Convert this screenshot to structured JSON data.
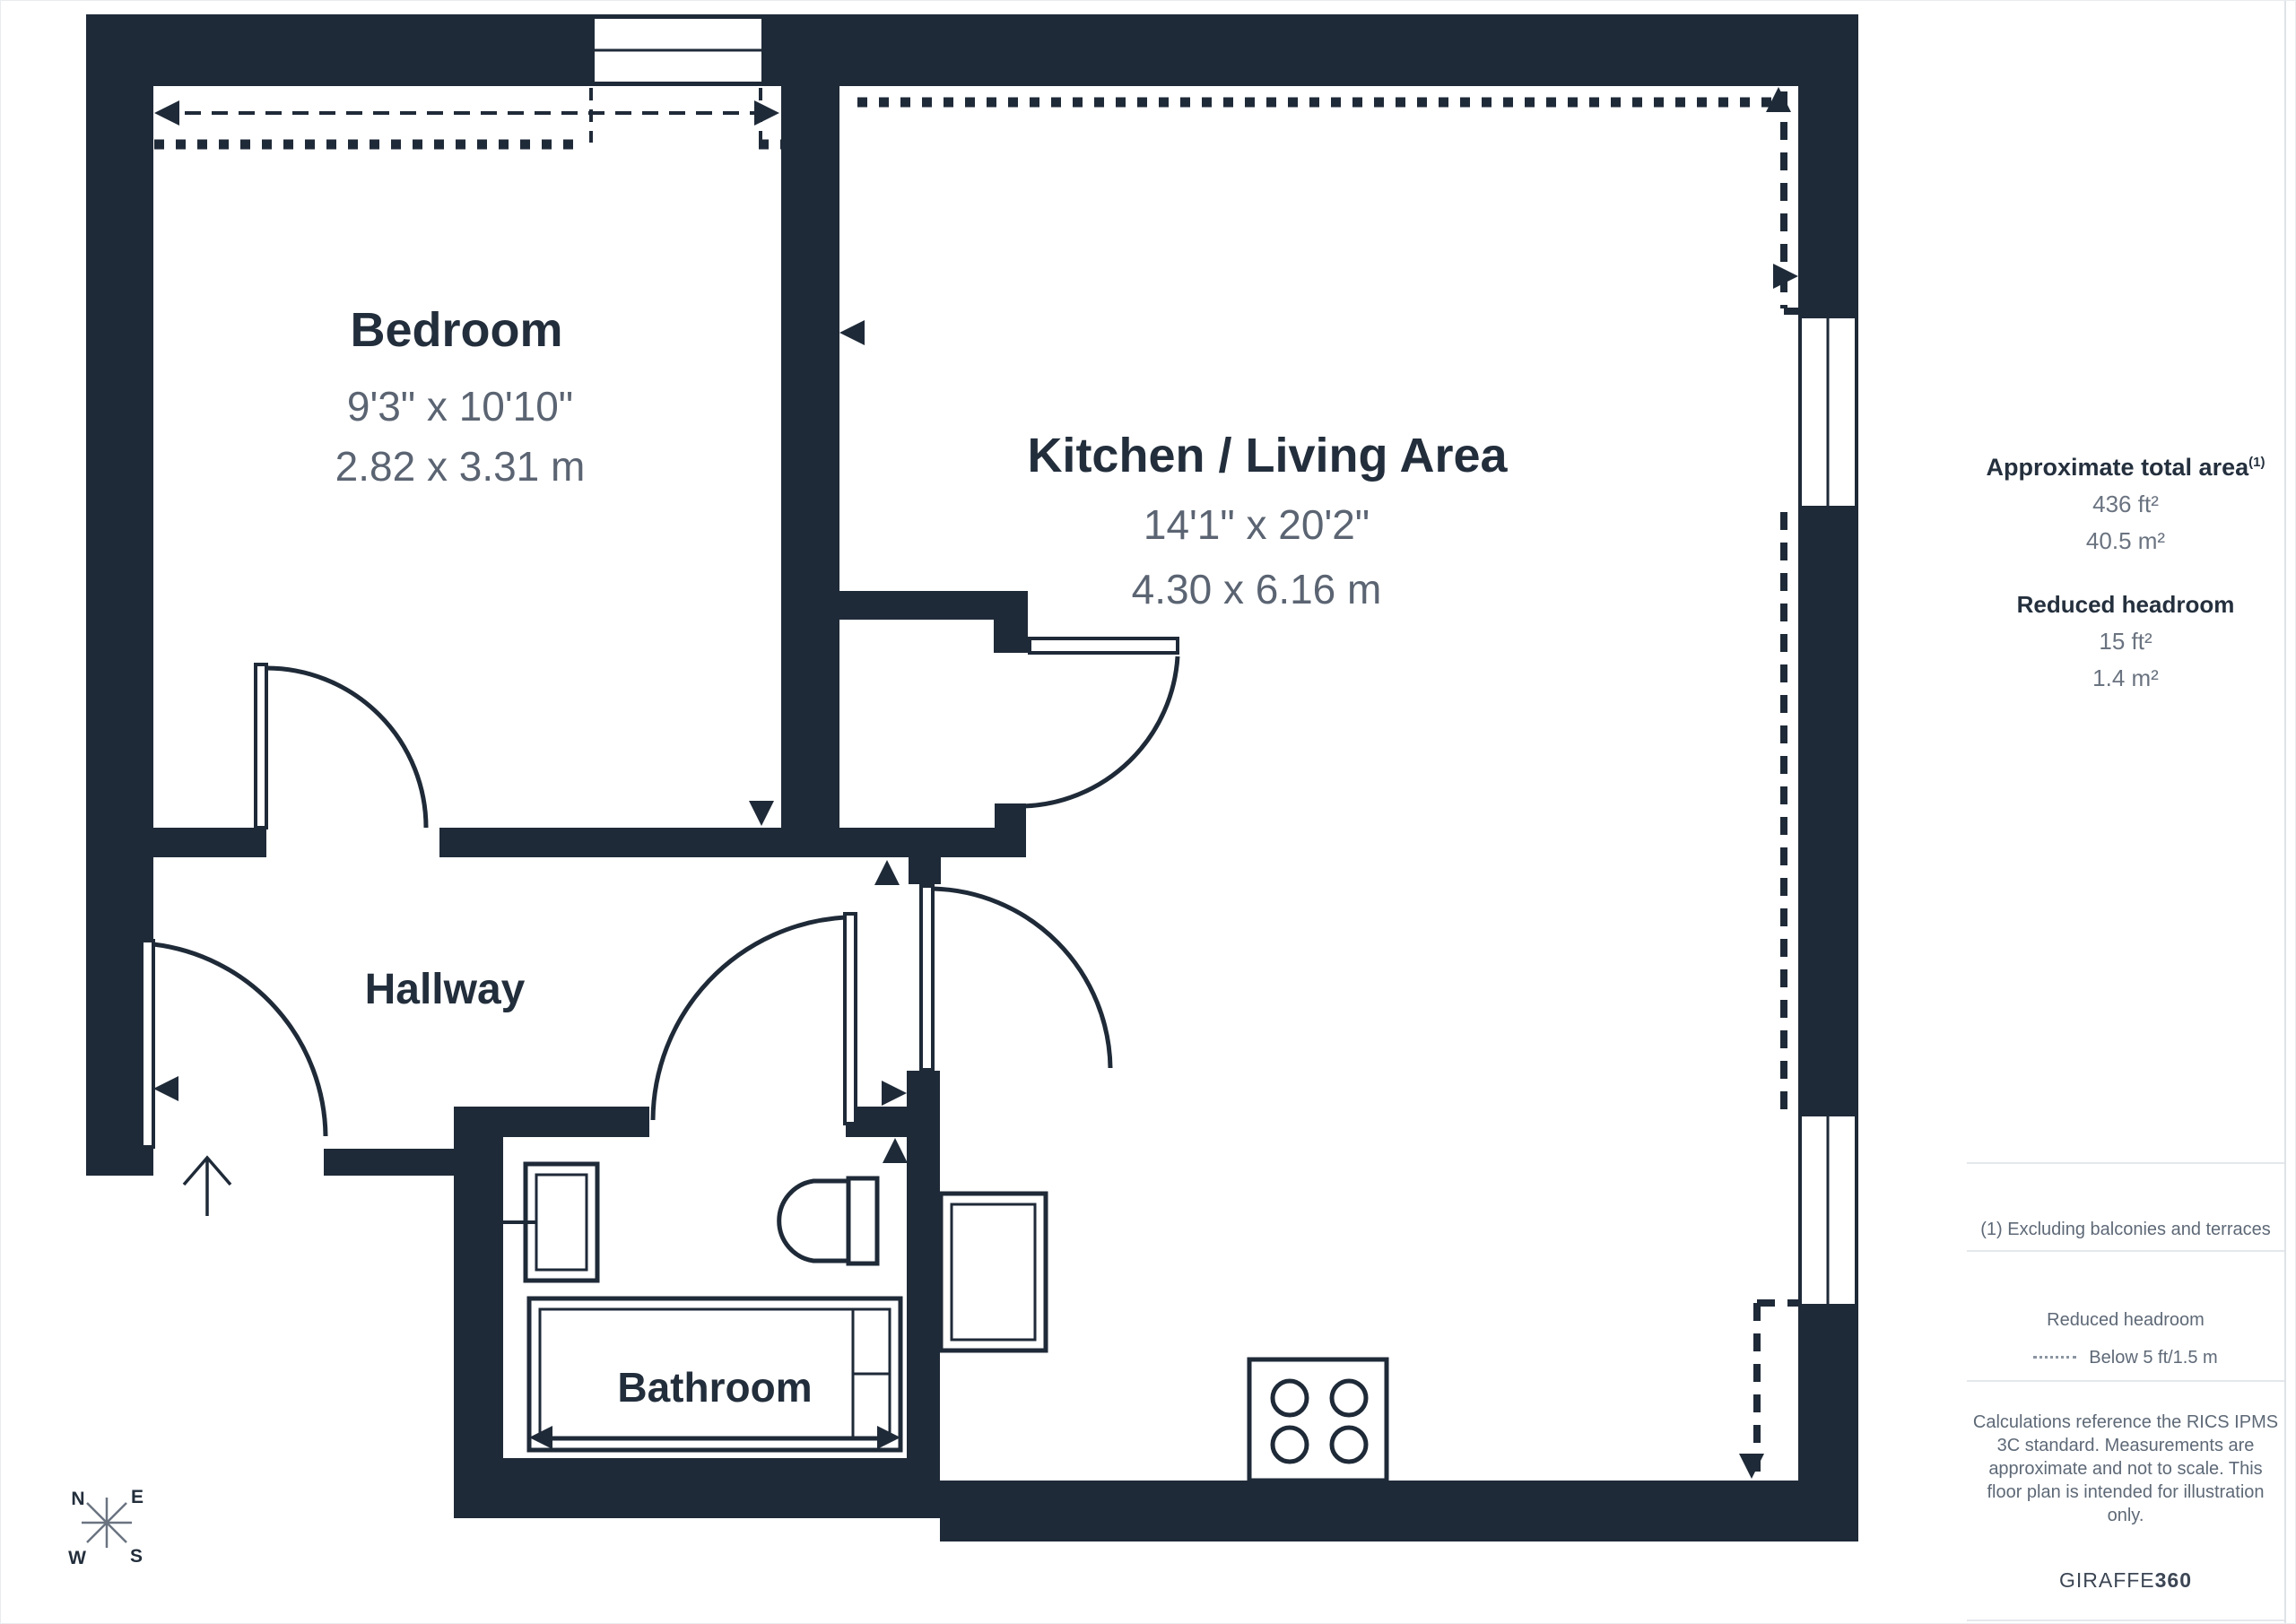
{
  "colors": {
    "wall": "#1f2a38",
    "room_title_text": "#232e3c",
    "dimension_text": "#5b6472",
    "sidebar_border": "#dfe3e8",
    "background": "#ffffff"
  },
  "plan": {
    "rooms": [
      {
        "id": "bedroom",
        "name": "Bedroom",
        "imperial": "9'3\" x 10'10\"",
        "metric": "2.82 x 3.31 m"
      },
      {
        "id": "kitchen-living",
        "name": "Kitchen / Living Area",
        "imperial": "14'1\" x 20'2\"",
        "metric": "4.30 x 6.16 m"
      },
      {
        "id": "hallway",
        "name": "Hallway"
      },
      {
        "id": "bathroom",
        "name": "Bathroom"
      }
    ],
    "compass": {
      "n": "N",
      "e": "E",
      "w": "W",
      "s": "S"
    }
  },
  "sidebar": {
    "total_area": {
      "label": "Approximate total area",
      "footnote_marker": "(1)",
      "imperial": "436 ft²",
      "metric": "40.5 m²"
    },
    "reduced_headroom": {
      "label": "Reduced headroom",
      "imperial": "15 ft²",
      "metric": "1.4 m²"
    },
    "footnote": "(1) Excluding balconies and terraces",
    "legend": {
      "title": "Reduced headroom",
      "item": "Below 5 ft/1.5 m"
    },
    "disclaimer_lines": [
      "Calculations reference the RICS IPMS",
      "3C standard. Measurements are",
      "approximate and not to scale. This",
      "floor plan is intended for illustration",
      "only."
    ],
    "brand": {
      "name": "GIRAFFE",
      "suffix": "360"
    }
  }
}
